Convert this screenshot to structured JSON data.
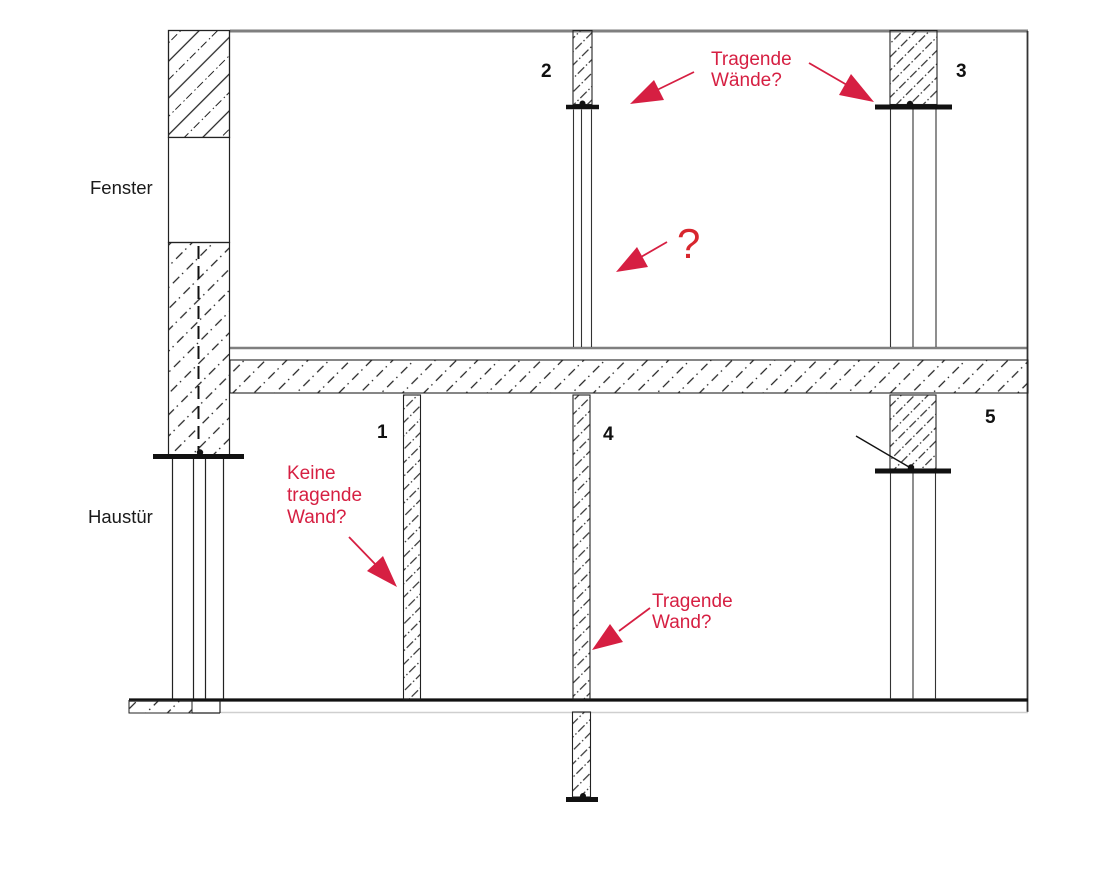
{
  "labels": {
    "window": "Fenster",
    "front_door": "Haustür"
  },
  "wall_numbers": {
    "w1": "1",
    "w2": "2",
    "w3": "3",
    "w4": "4",
    "w5": "5"
  },
  "annotations": {
    "load_bearing_walls": {
      "line1": "Tragende",
      "line2": "Wände?"
    },
    "question": "?",
    "no_load_bearing": {
      "line1": "Keine",
      "line2": "tragende",
      "line3": "Wand?"
    },
    "load_bearing_wall": {
      "line1": "Tragende",
      "line2": "Wand?"
    }
  },
  "colors": {
    "annotation_red": "#d61f42",
    "question_red": "#d8262e",
    "structure_gray": "#7f7f7f",
    "ink": "#1a1a1a"
  }
}
